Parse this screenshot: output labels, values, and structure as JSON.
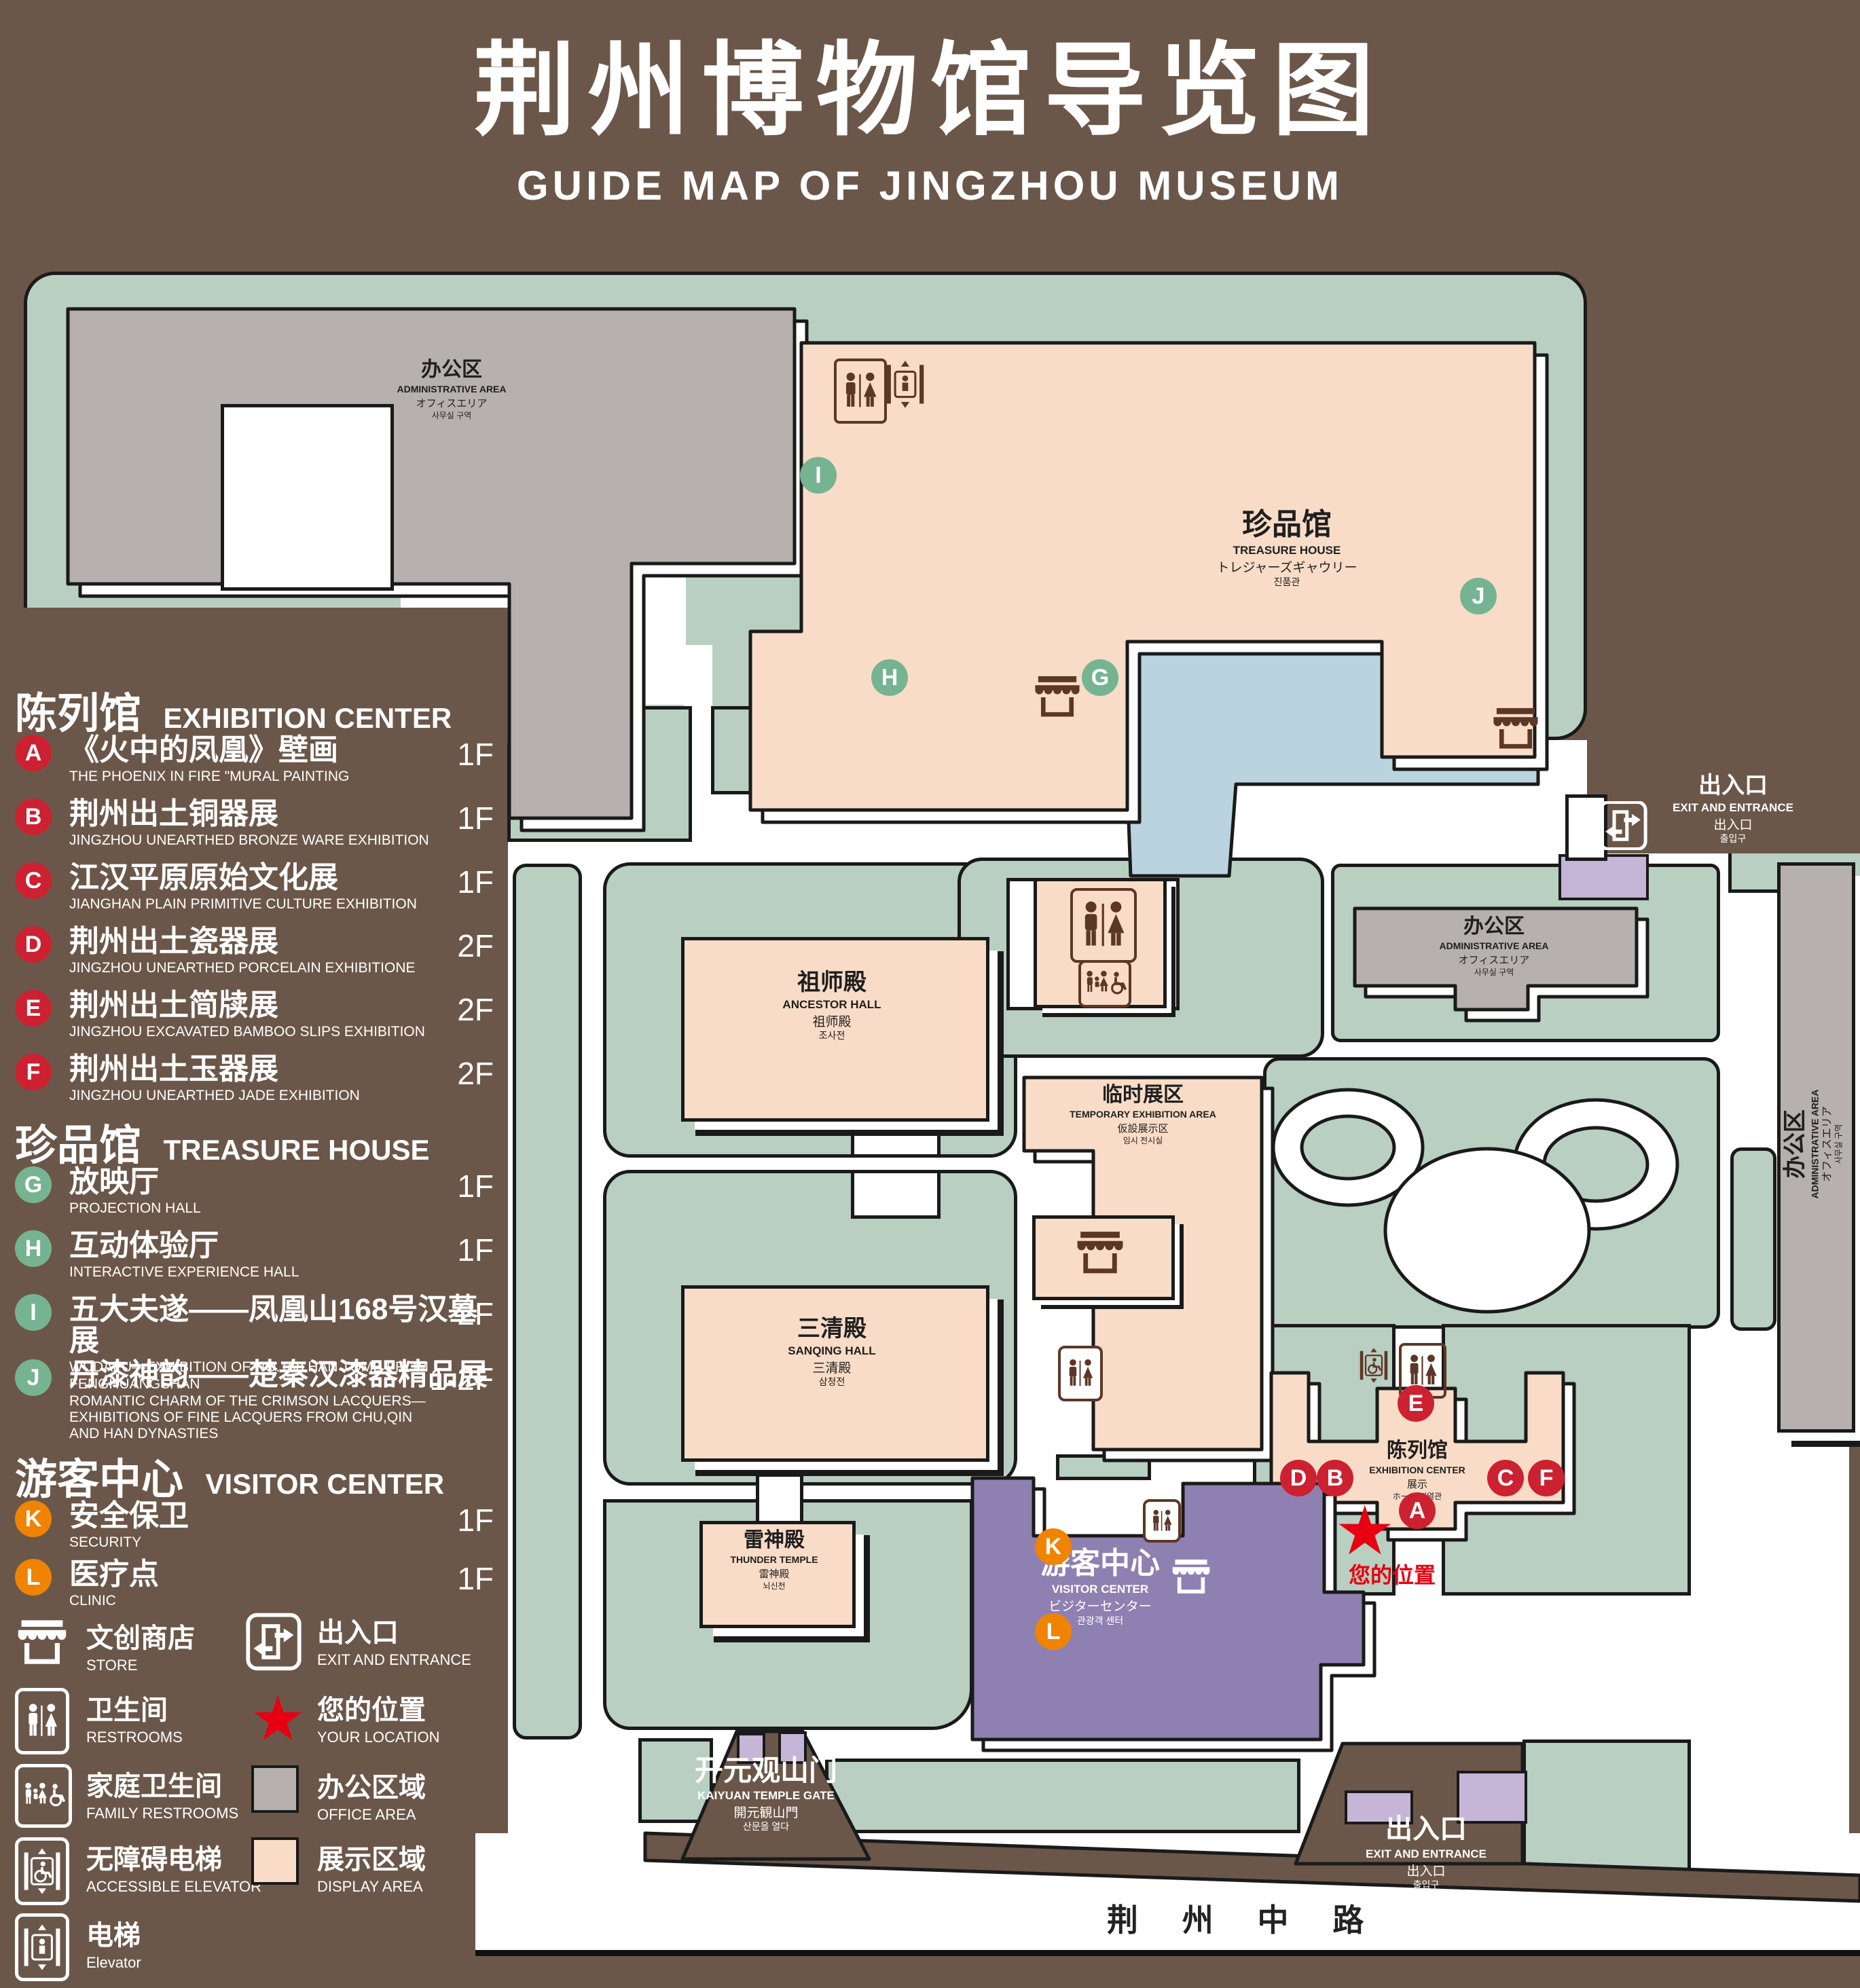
{
  "title": {
    "zh": "荆州博物馆导览图",
    "en": "GUIDE MAP OF JINGZHOU MUSEUM"
  },
  "colors": {
    "background": "#6b5749",
    "landscape_green": "#b8cfc2",
    "display_area": "#f8dcc7",
    "office_area": "#b6b1ae",
    "water": "#b9d4df",
    "visitor_center": "#8f80b2",
    "gate_building": "#c6b5d7",
    "marker_red": "#cc2131",
    "marker_green": "#76b491",
    "marker_orange": "#f08300",
    "icon_brown": "#5d3726",
    "location_red": "#e60012",
    "outline": "#1a1a1a"
  },
  "legend": {
    "sections": [
      {
        "zh": "陈列馆",
        "en": "EXHIBITION CENTER",
        "items": [
          {
            "letter": "A",
            "zh": "《火中的凤凰》壁画",
            "en": "THE PHOENIX IN FIRE \"MURAL PAINTING",
            "floor": "1F"
          },
          {
            "letter": "B",
            "zh": "荆州出土铜器展",
            "en": "JINGZHOU UNEARTHED BRONZE WARE EXHIBITION",
            "floor": "1F"
          },
          {
            "letter": "C",
            "zh": "江汉平原原始文化展",
            "en": "JIANGHAN PLAIN PRIMITIVE CULTURE EXHIBITION",
            "floor": "1F"
          },
          {
            "letter": "D",
            "zh": "荆州出土瓷器展",
            "en": "JINGZHOU UNEARTHED PORCELAIN EXHIBITIONE",
            "floor": "2F"
          },
          {
            "letter": "E",
            "zh": "荆州出土简牍展",
            "en": "JINGZHOU EXCAVATED BAMBOO SLIPS EXHIBITION",
            "floor": "2F"
          },
          {
            "letter": "F",
            "zh": "荆州出土玉器展",
            "en": "JINGZHOU UNEARTHED JADE EXHIBITION",
            "floor": "2F"
          }
        ]
      },
      {
        "zh": "珍品馆",
        "en": "TREASURE HOUSE",
        "items": [
          {
            "letter": "G",
            "zh": "放映厅",
            "en": "PROJECTION HALL",
            "floor": "1F"
          },
          {
            "letter": "H",
            "zh": "互动体验厅",
            "en": "INTERACTIVE EXPERIENCE HALL",
            "floor": "1F"
          },
          {
            "letter": "I",
            "zh": "五大夫遂——凤凰山168号汉墓展",
            "en": "WUDAFU—EXHIBITION OF NO.168 HAN TOMB FROM FENGHUANGSHAN",
            "floor": "2F"
          },
          {
            "letter": "J",
            "zh": "丹漆神韵——楚秦汉漆器精品展",
            "en": "ROMANTIC CHARM OF THE CRIMSON LACQUERS—EXHIBITIONS OF FINE LACQUERS FROM CHU,QIN AND HAN DYNASTIES",
            "floor": "1-2F"
          }
        ]
      },
      {
        "zh": "游客中心",
        "en": "VISITOR CENTER",
        "items": [
          {
            "letter": "K",
            "zh": "安全保卫",
            "en": "SECURITY",
            "floor": "1F"
          },
          {
            "letter": "L",
            "zh": "医疗点",
            "en": "CLINIC",
            "floor": "1F"
          }
        ]
      }
    ],
    "facilities": [
      {
        "icon": "store-icon",
        "zh": "文创商店",
        "en": "STORE"
      },
      {
        "icon": "exit-icon",
        "zh": "出入口",
        "en": "EXIT AND ENTRANCE"
      },
      {
        "icon": "restrooms-icon",
        "zh": "卫生间",
        "en": "RESTROOMS"
      },
      {
        "icon": "your-location-star",
        "zh": "您的位置",
        "en": "YOUR LOCATION"
      },
      {
        "icon": "family-restrooms-icon",
        "zh": "家庭卫生间",
        "en": "FAMILY RESTROOMS"
      },
      {
        "icon": "office-area-swatch",
        "zh": "办公区域",
        "en": "OFFICE AREA",
        "color": "#b6b1ae"
      },
      {
        "icon": "accessible-elevator-icon",
        "zh": "无障碍电梯",
        "en": "ACCESSIBLE ELEVATOR"
      },
      {
        "icon": "display-area-swatch",
        "zh": "展示区域",
        "en": "DISPLAY AREA",
        "color": "#f8dcc7"
      },
      {
        "icon": "elevator-icon",
        "zh": "电梯",
        "en": "Elevator"
      }
    ]
  },
  "map": {
    "admin": {
      "zh": "办公区",
      "en": "ADMINISTRATIVE AREA",
      "jp": "オフィスエリア",
      "kr": "사무실 구역"
    },
    "treasure": {
      "zh": "珍品馆",
      "en": "TREASURE HOUSE",
      "jp": "トレジャーズギャウリー",
      "kr": "진품관"
    },
    "ancestor": {
      "zh": "祖师殿",
      "en": "ANCESTOR HALL",
      "jp": "祖师殿",
      "kr": "조사전"
    },
    "temporary": {
      "zh": "临时展区",
      "en": "TEMPORARY EXHIBITION AREA",
      "jp": "仮設展示区",
      "kr": "임시 전시실"
    },
    "sanqing": {
      "zh": "三清殿",
      "en": "SANQING HALL",
      "jp": "三清殿",
      "kr": "삼청전"
    },
    "thunder": {
      "zh": "雷神殿",
      "en": "THUNDER TEMPLE",
      "jp": "雷神殿",
      "kr": "뇌신전"
    },
    "visitor": {
      "zh": "游客中心",
      "en": "VISITOR CENTER",
      "jp": "ビジターセンター",
      "kr": "관광객 센터"
    },
    "exhibition": {
      "zh": "陈列馆",
      "en": "EXHIBITION CENTER",
      "jp": "展示",
      "kr": "ホール 진열관"
    },
    "exit": {
      "zh": "出入口",
      "en": "EXIT AND ENTRANCE",
      "jp": "出入口",
      "kr": "출입구"
    },
    "gate": {
      "zh": "开元观山门",
      "en": "KAIYUAN TEMPLE GATE",
      "jp": "開元観山門",
      "kr": "산문을 열다"
    },
    "road": "荆 州 中 路",
    "your_location": "您的位置",
    "markers": {
      "A": {
        "letter": "A"
      },
      "B": {
        "letter": "B"
      },
      "C": {
        "letter": "C"
      },
      "D": {
        "letter": "D"
      },
      "E": {
        "letter": "E"
      },
      "F": {
        "letter": "F"
      },
      "G": {
        "letter": "G"
      },
      "H": {
        "letter": "H"
      },
      "I": {
        "letter": "I"
      },
      "J": {
        "letter": "J"
      },
      "K": {
        "letter": "K"
      },
      "L": {
        "letter": "L"
      }
    }
  }
}
